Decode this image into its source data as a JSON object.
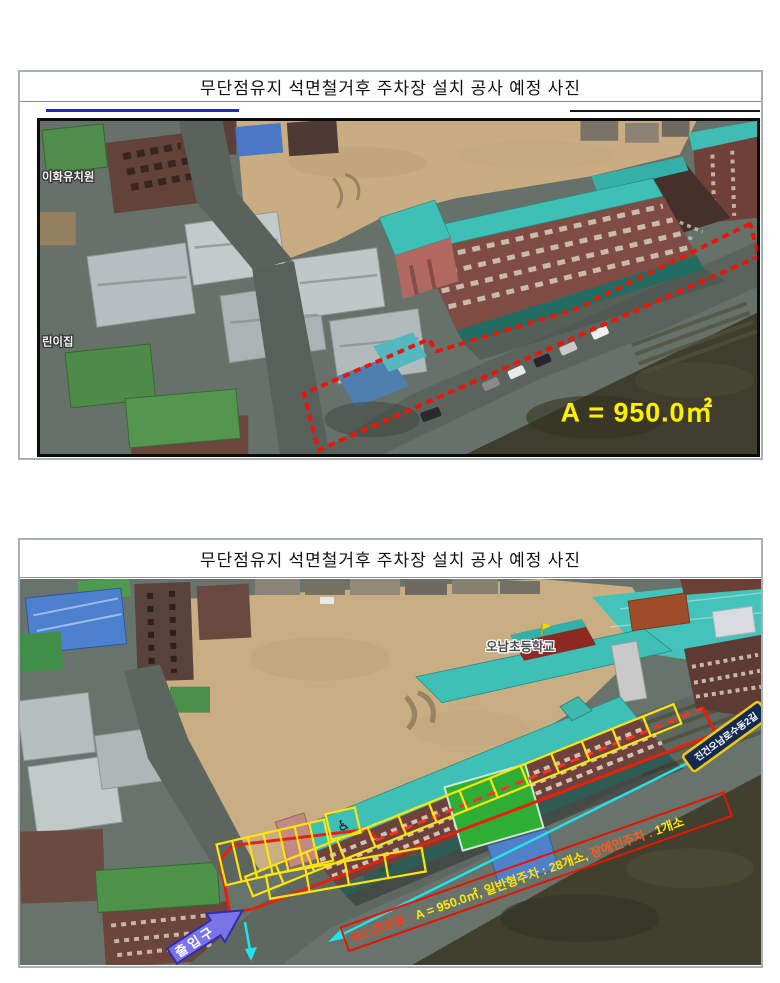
{
  "page": {
    "panel1": {
      "title": "무단점유지 석면철거후 주차장 설치 공사 예정 사진",
      "photo": {
        "label_kindergarten": "이화유치원",
        "label_daycare": "린이집",
        "area_label": "A = 950.0㎡"
      }
    },
    "panel2": {
      "title": "무단점유지 석면철거후 주차장 설치 공사 예정 사진",
      "photo": {
        "label_school": "오남초등학교",
        "street_sign": "진건오남로수동2길",
        "entrance_label": "출입구",
        "disabled_icon": "♿",
        "spec": {
          "seg1": {
            "text": "아스콘포장 : ",
            "color": "#ff3c14"
          },
          "seg2": {
            "text": "A = 950.0㎡, ",
            "color": "#ffec00"
          },
          "seg3": {
            "text": "일반형주차 : 28개소, ",
            "color": "#ffe400"
          },
          "seg4": {
            "text": "장애인주차 : ",
            "color": "#ff5a1e"
          },
          "seg5": {
            "text": "1개소",
            "color": "#ffec00"
          }
        }
      }
    },
    "colors": {
      "annotation_red": "#ee1408",
      "annotation_yellow": "#ffe40a",
      "annotation_cyan": "#25e2ea",
      "area_text_yellow": "#ffef00",
      "entrance_arrow_blue": "#7b74e8"
    }
  }
}
